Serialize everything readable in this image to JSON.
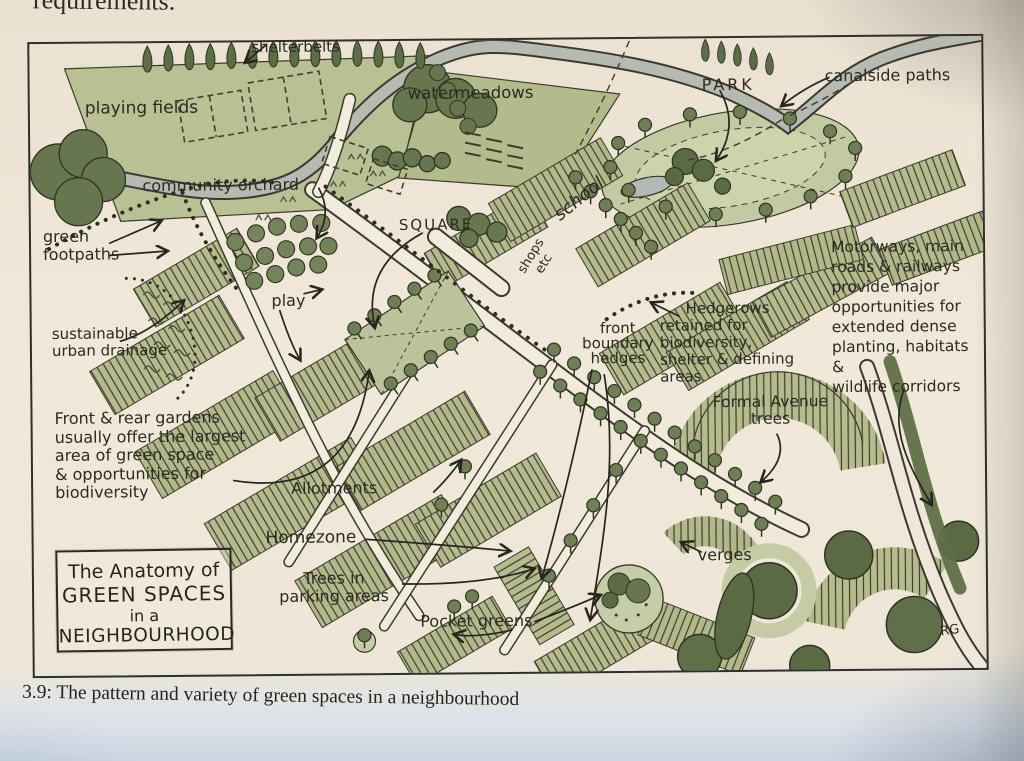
{
  "page": {
    "overflow_text_top": "requirements.",
    "caption": "3.9: The pattern and variety of green spaces in a neighbourhood",
    "artist_initials": "RG"
  },
  "figure": {
    "title_box": [
      "The Anatomy of",
      "GREEN SPACES",
      "in a",
      "NEIGHBOURHOOD"
    ],
    "labels": {
      "shelterbelts": "shelterbelts",
      "playing_fields": "playing fields",
      "water_meadows": "watermeadows",
      "park": "PARK",
      "canalside_paths": "canalside paths",
      "community_orchard": "community orchard",
      "green_footpaths": "green\nfootpaths",
      "square": "SQUARE",
      "school": "school",
      "shops": "shops\netc",
      "play": "play",
      "suds": "sustainable\nurban drainage",
      "hedgerows": "Hedgerows\nretained for\nbiodiversity,\nshelter & defining\nareas",
      "front_boundary_hedges": "front\nboundary\nhedges",
      "motorways": "Motorways, main\nroads & railways\nprovide major\nopportunities for\nextended dense\nplanting, habitats &\nwildlife corridors",
      "formal_avenue_trees": "Formal Avenue\ntrees",
      "front_rear_gardens": "Front & rear gardens\nusually offer the largest\narea of green space\n& opportunities for\nbiodiversity",
      "allotments": "Allotments",
      "homezone": "Homezone",
      "trees_in_parking": "Trees in\nparking areas",
      "pocket_greens": "Pocket greens",
      "verges": "verges"
    }
  },
  "colors": {
    "paper": "#efe7d8",
    "ink": "#2d2d24",
    "garden_sage": "#b5bb8d",
    "park_green": "#c3caa1",
    "tree_dark": "#5d6e47",
    "tree_mid": "#74835a",
    "river_grey": "#b6bab1",
    "page_shadow_blue": "#ccd5e0"
  }
}
